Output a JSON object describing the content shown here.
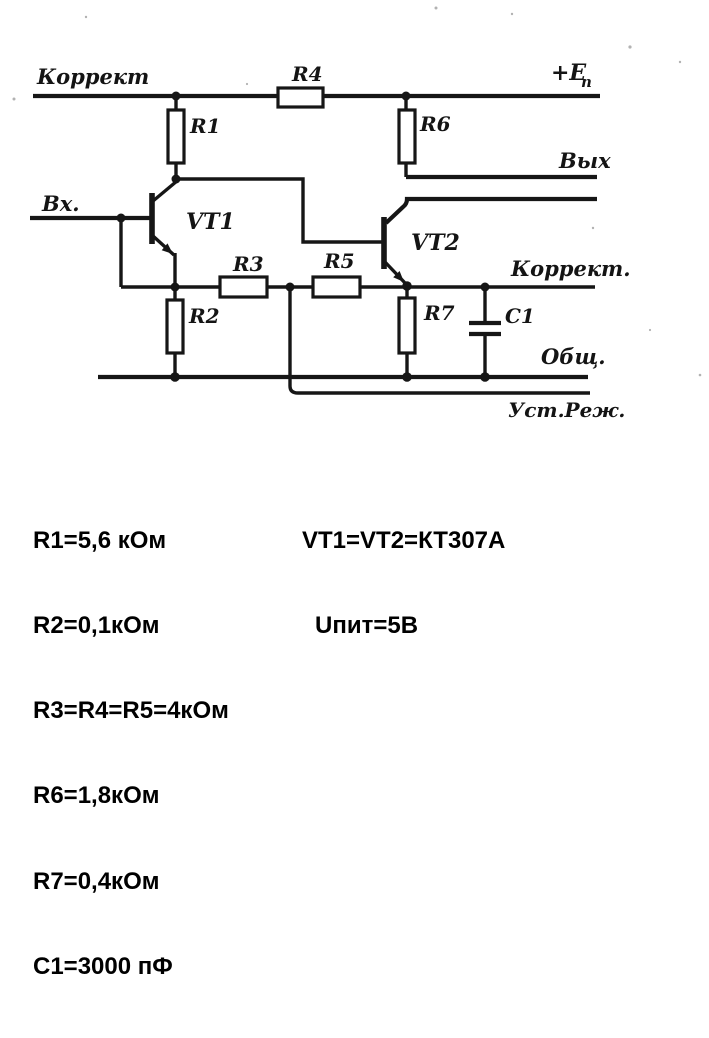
{
  "schematic": {
    "labels": {
      "correct_top": "Коррект",
      "r4": "R4",
      "supply_main": "+E",
      "supply_sub": "п",
      "r1": "R1",
      "r6": "R6",
      "output": "Вых",
      "input": "Вх.",
      "vt1": "VT1",
      "vt2": "VT2",
      "r3": "R3",
      "r5": "R5",
      "correct_right": "Коррект.",
      "r2": "R2",
      "r7": "R7",
      "c1": "С1",
      "common": "Общ.",
      "mode_set": "Уст.Реж."
    }
  },
  "parameters": {
    "left": [
      "R1=5,6 кОм",
      "R2=0,1кОм",
      "R3=R4=R5=4кОм",
      "R6=1,8кОм",
      "R7=0,4кОм",
      "C1=3000 пФ"
    ],
    "right": [
      "VT1=VT2=КТ307А",
      "Uпит=5В"
    ]
  },
  "colors": {
    "ink": "#161616",
    "paper": "#ffffff"
  }
}
